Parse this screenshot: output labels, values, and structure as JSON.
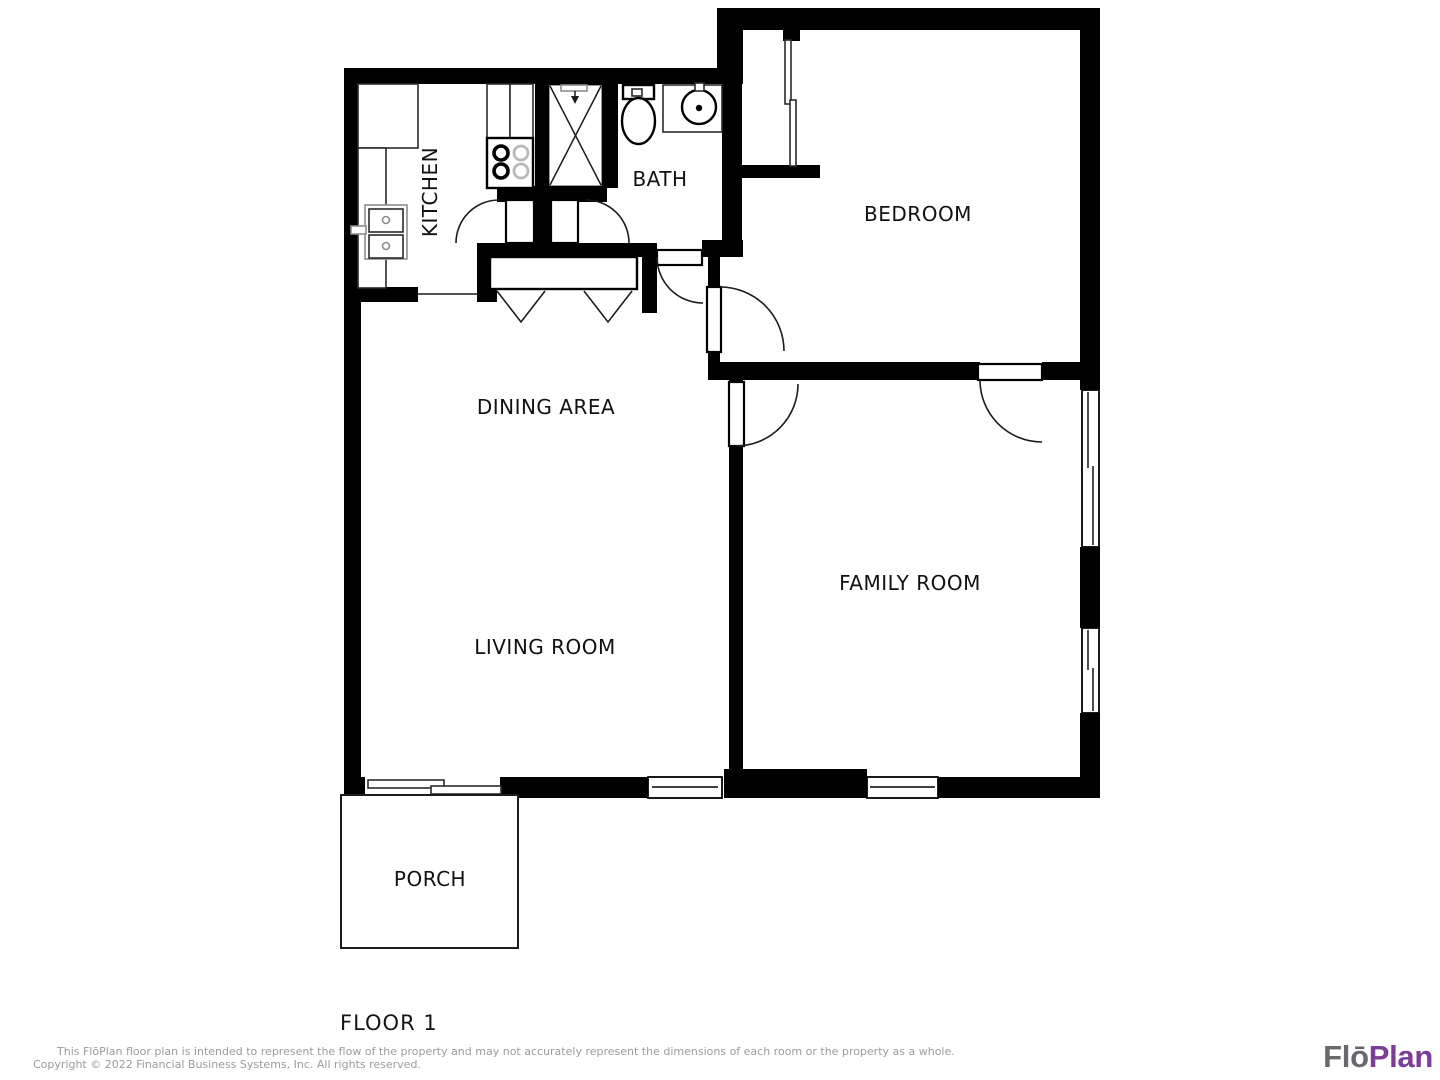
{
  "floor_plan": {
    "floor_label": "FLOOR 1",
    "rooms": [
      {
        "id": "kitchen",
        "label": "KITCHEN"
      },
      {
        "id": "bath",
        "label": "BATH"
      },
      {
        "id": "bedroom",
        "label": "BEDROOM"
      },
      {
        "id": "dining-area",
        "label": "DINING AREA"
      },
      {
        "id": "living-room",
        "label": "LIVING ROOM"
      },
      {
        "id": "family-room",
        "label": "FAMILY ROOM"
      },
      {
        "id": "porch",
        "label": "PORCH"
      }
    ],
    "wall_color": "#000000",
    "background_color": "#ffffff"
  },
  "footer": {
    "disclaimer_line1": "This FlōPlan floor plan is intended to represent the flow of the property and may not accurately represent the dimensions of each room or the property as a whole.",
    "disclaimer_line2": "Copyright © 2022 Financial Business Systems, Inc. All rights reserved.",
    "disclaimer_color": "#9b9b9b",
    "logo": {
      "part1": "Flō",
      "part2": "Plan",
      "part1_color": "#6a686d",
      "part2_color": "#7d3c98"
    }
  }
}
